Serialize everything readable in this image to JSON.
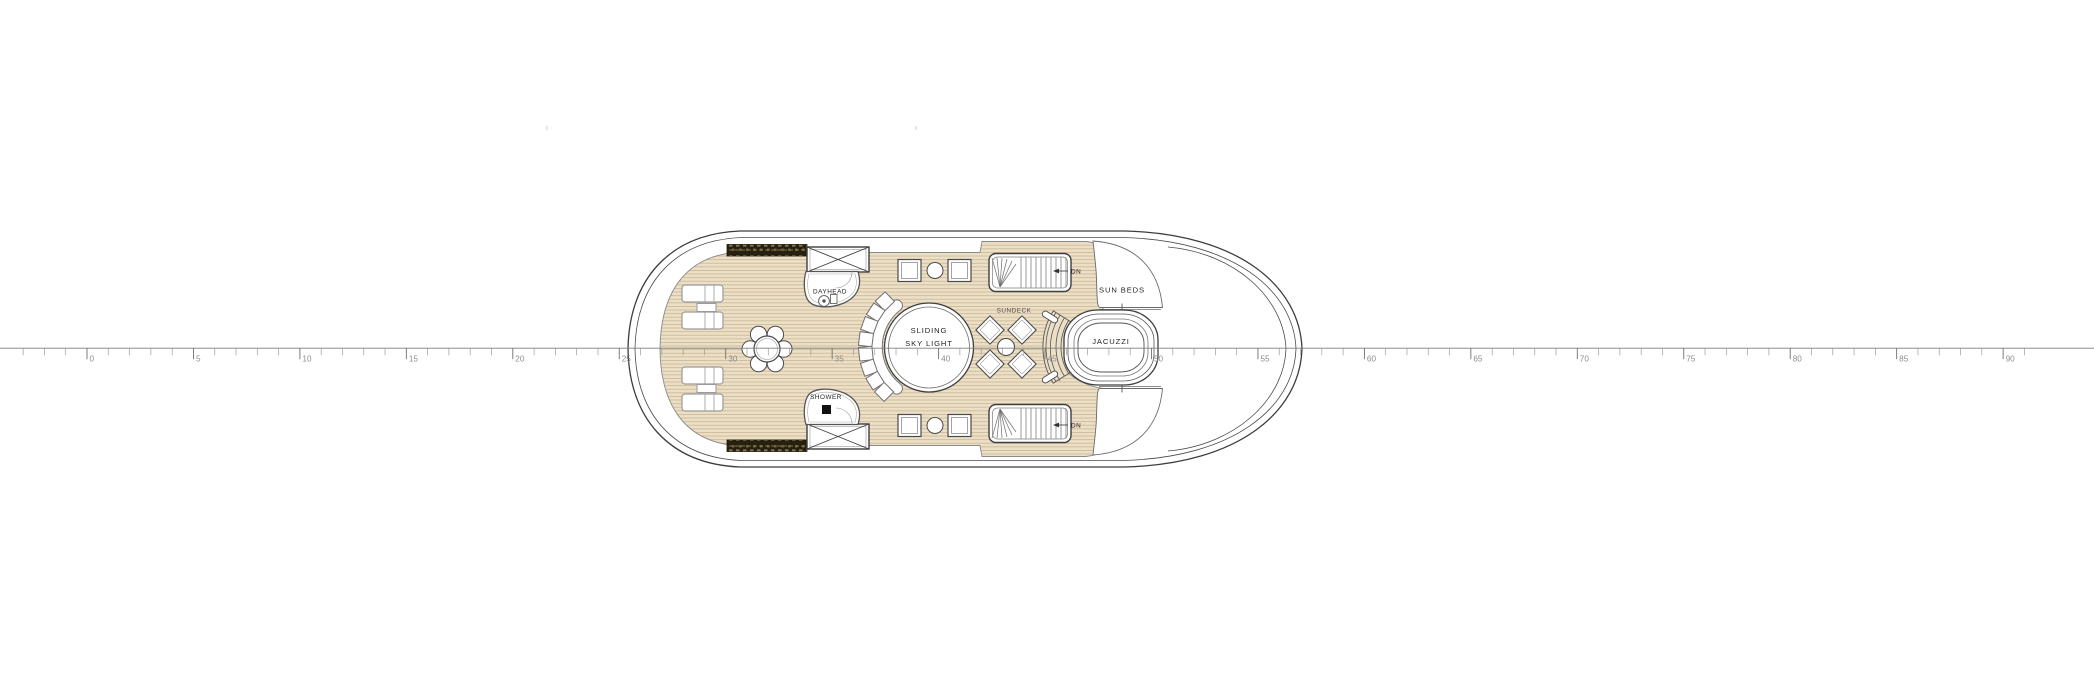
{
  "document": {
    "kind": "yacht-sundeck-floor-plan"
  },
  "ruler": {
    "unit_step": 5,
    "tick_labels": [
      "0",
      "5",
      "10",
      "15",
      "20",
      "25",
      "30",
      "35",
      "40",
      "45",
      "50",
      "55",
      "60",
      "65",
      "70",
      "75",
      "80",
      "85",
      "90"
    ]
  },
  "plan_labels": {
    "dayhead": "DAYHEAD",
    "shower": "SHOWER",
    "skylight_line1": "SLIDING",
    "skylight_line2": "SKY LIGHT",
    "sundeck": "SUNDECK",
    "sun_beds": "SUN BEDS",
    "jacuzzi": "JACUZZI",
    "stairs_down_top": "DN",
    "stairs_down_bottom": "DN"
  },
  "colors": {
    "deck_teak": "#ebdfc6",
    "plank_line": "#c9b291",
    "hull_line": "#3d3d3d",
    "room_line": "#555555",
    "furniture_line": "#9a9a9a",
    "vent_dark": "#26200f",
    "ruler_line": "#7d7d7d"
  }
}
